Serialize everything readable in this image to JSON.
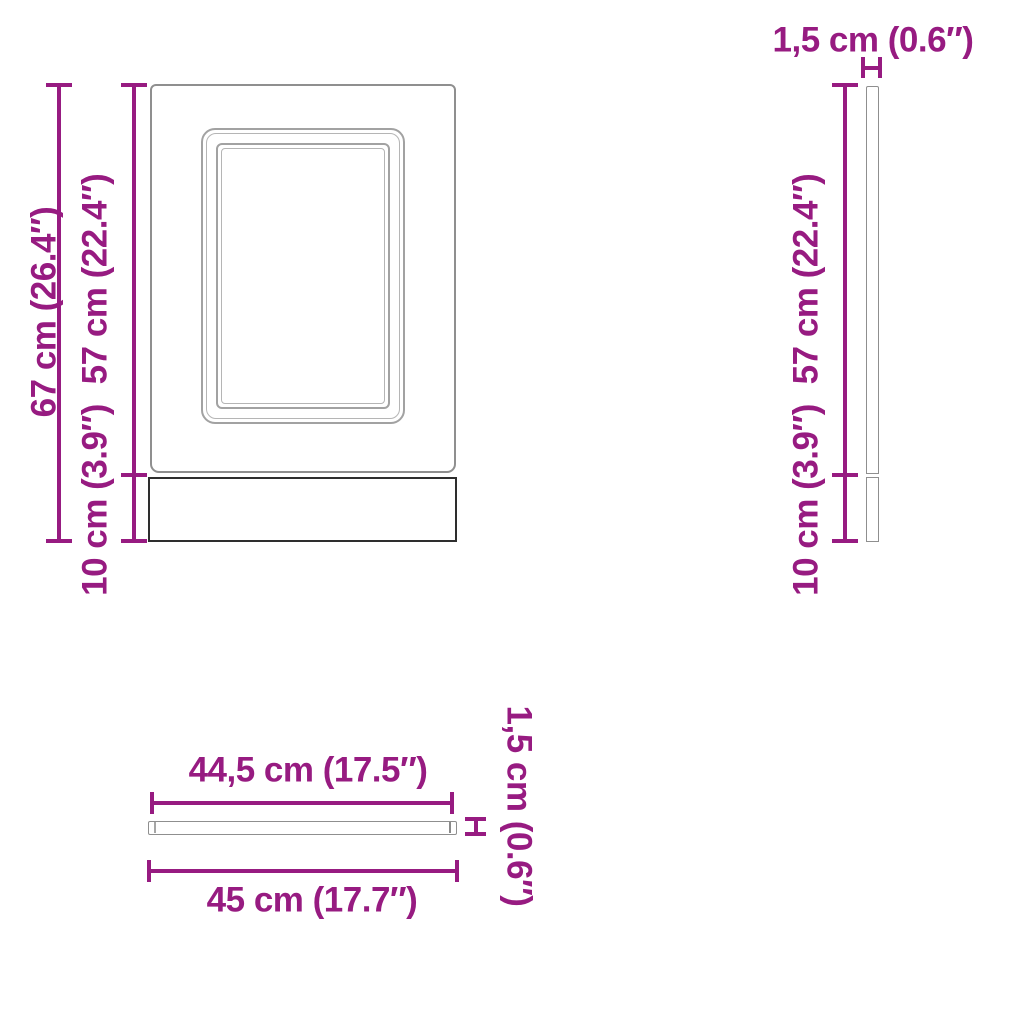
{
  "diagram_title": "dishwasher panel dimensions",
  "views": {
    "front": {
      "name": "front view",
      "total_height": "67 cm (26.4″)",
      "door_height": "57 cm (22.4″)",
      "plinth_height": "10 cm (3.9″)"
    },
    "side": {
      "name": "side view",
      "thickness": "1,5 cm (0.6″)",
      "door_height": "57 cm (22.4″)",
      "plinth_height": "10 cm (3.9″)"
    },
    "top": {
      "name": "top view",
      "inner_width": "44,5 cm (17.5″)",
      "total_width": "45 cm (17.7″)",
      "thickness": "1,5 cm (0.6″)"
    }
  },
  "colors": {
    "dimension": "#971b81",
    "outline_light": "#8f8f8f",
    "outline_lighter": "#b5b5b5",
    "outline_dark": "#2e2e2e"
  }
}
